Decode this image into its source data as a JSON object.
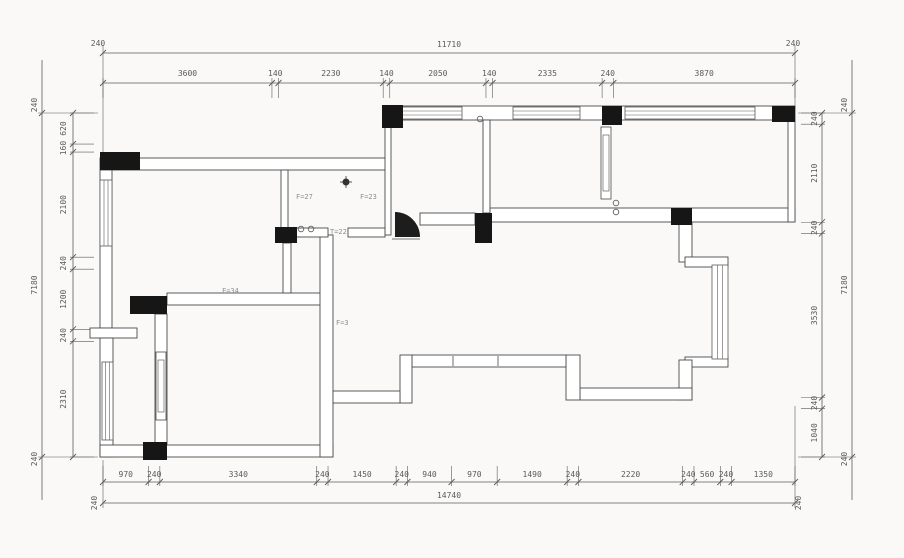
{
  "title": "apartment-floor-plan",
  "colors": {
    "background": "#faf9f7",
    "wall_stroke": "#4a4a4a",
    "wall_fill": "#ffffff",
    "column_fill": "#161616",
    "dim_color": "#5a5a5a",
    "label_color": "#8f8f8f",
    "window_color": "#5a5a5a"
  },
  "dimensions": {
    "top": {
      "ends": [
        "240",
        "240"
      ],
      "total": "11710",
      "segments": [
        "3600",
        "140",
        "2230",
        "140",
        "2050",
        "140",
        "2335",
        "240",
        "3870"
      ]
    },
    "bottom": {
      "ends": [
        "240",
        "240"
      ],
      "total": "14740",
      "segments": [
        "970",
        "240",
        "3340",
        "240",
        "1450",
        "240",
        "940",
        "970",
        "1490",
        "240",
        "2220",
        "240",
        "560",
        "240",
        "1350"
      ]
    },
    "left": {
      "ends": [
        "240",
        "240"
      ],
      "total": "7180",
      "segments": [
        "620",
        "160",
        "2100",
        "240",
        "1200",
        "240",
        "2310"
      ]
    },
    "right": {
      "ends": [
        "240",
        "240"
      ],
      "total": "7180",
      "segments": [
        "240",
        "2110",
        "240",
        "3530",
        "240",
        "1040"
      ]
    }
  },
  "plan": {
    "walls": [
      [
        100,
        158,
        290,
        12
      ],
      [
        100,
        170,
        12,
        158
      ],
      [
        90,
        328,
        47,
        10
      ],
      [
        100,
        338,
        13,
        119
      ],
      [
        100,
        445,
        233,
        12
      ],
      [
        167,
        293,
        156,
        12
      ],
      [
        155,
        314,
        12,
        130
      ],
      [
        320,
        235,
        13,
        222
      ],
      [
        281,
        170,
        7,
        65
      ],
      [
        385,
        127,
        6,
        108
      ],
      [
        288,
        228,
        40,
        9
      ],
      [
        348,
        228,
        37,
        9
      ],
      [
        402,
        106,
        393,
        14
      ],
      [
        483,
        120,
        7,
        93
      ],
      [
        490,
        208,
        305,
        14
      ],
      [
        788,
        120,
        7,
        102
      ],
      [
        420,
        213,
        55,
        12
      ],
      [
        679,
        222,
        13,
        40
      ],
      [
        685,
        257,
        43,
        10
      ],
      [
        685,
        357,
        43,
        10
      ],
      [
        679,
        360,
        13,
        40
      ],
      [
        580,
        388,
        112,
        12
      ],
      [
        566,
        355,
        14,
        45
      ],
      [
        412,
        355,
        154,
        12
      ],
      [
        400,
        355,
        12,
        48
      ],
      [
        333,
        391,
        67,
        12
      ],
      [
        283,
        243,
        8,
        50
      ]
    ],
    "columns": [
      [
        100,
        152,
        40,
        18
      ],
      [
        275,
        227,
        22,
        16
      ],
      [
        382,
        105,
        21,
        23
      ],
      [
        602,
        106,
        20,
        19
      ],
      [
        772,
        106,
        23,
        16
      ],
      [
        475,
        213,
        17,
        30
      ],
      [
        671,
        208,
        21,
        17
      ],
      [
        130,
        296,
        37,
        18
      ],
      [
        143,
        442,
        24,
        18
      ]
    ],
    "windows": [
      {
        "x": 100,
        "y": 180,
        "w": 12,
        "h": 66,
        "dir": "v"
      },
      {
        "x": 102,
        "y": 362,
        "w": 11,
        "h": 78,
        "dir": "v"
      },
      {
        "x": 402,
        "y": 107,
        "w": 60,
        "h": 12,
        "dir": "h"
      },
      {
        "x": 513,
        "y": 107,
        "w": 67,
        "h": 12,
        "dir": "h"
      },
      {
        "x": 625,
        "y": 107,
        "w": 130,
        "h": 12,
        "dir": "h"
      },
      {
        "x": 712,
        "y": 265,
        "w": 16,
        "h": 94,
        "dir": "v"
      }
    ],
    "cabinets": [
      [
        601,
        127,
        10,
        72
      ],
      [
        156,
        352,
        10,
        68
      ]
    ],
    "extra_lines": [
      [
        453,
        356,
        453,
        366
      ],
      [
        498,
        356,
        498,
        366
      ],
      [
        392,
        239,
        420,
        239
      ]
    ],
    "door_arc": {
      "x": 395,
      "y": 212,
      "r": 25
    },
    "target_symbols": [
      {
        "x": 346,
        "y": 182
      }
    ],
    "small_circles": [
      [
        301,
        229
      ],
      [
        311,
        229
      ],
      [
        616,
        203
      ],
      [
        616,
        212
      ],
      [
        480,
        119
      ]
    ],
    "room_labels": [
      {
        "text": "F=27",
        "x": 296,
        "y": 199
      },
      {
        "text": "F=23",
        "x": 360,
        "y": 199
      },
      {
        "text": "T=22",
        "x": 330,
        "y": 234
      },
      {
        "text": "F=34",
        "x": 222,
        "y": 293
      },
      {
        "text": "F=3",
        "x": 336,
        "y": 325
      }
    ]
  }
}
